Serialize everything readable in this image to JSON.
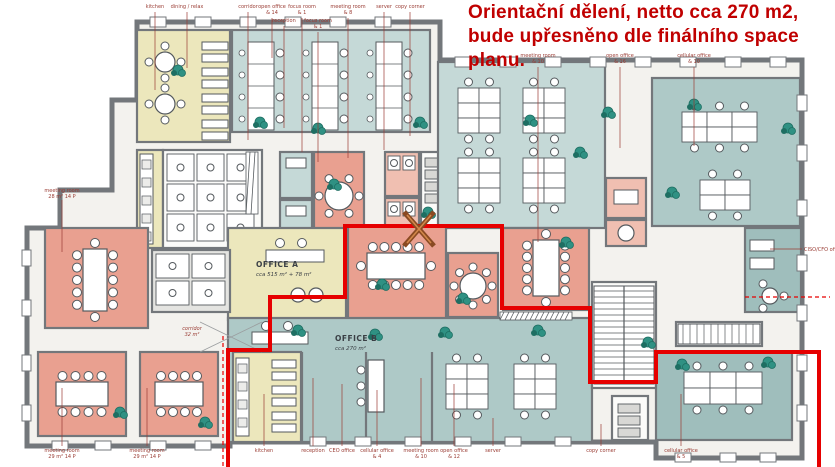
{
  "annotation": {
    "lines": [
      "Orientační dělení, netto cca 270 m2,",
      "bude upřesněno dle finálního space",
      "planu."
    ],
    "color": "#c00000"
  },
  "zones": {
    "office_a": {
      "title": "OFFICE A",
      "area": "cca 515 m² + 78 m²",
      "x": 256,
      "y": 267
    },
    "office_b": {
      "title": "OFFICE B",
      "area": "cca 270 m²",
      "x": 335,
      "y": 341
    }
  },
  "colors": {
    "wall": "#73777b",
    "interior": "#f3f2ee",
    "teal1": "#c5d9d7",
    "teal2": "#aec9c7",
    "teal3": "#9fbebc",
    "salmon": "#e9a090",
    "salmonL": "#f0bfb1",
    "cream": "#ece7bc",
    "white": "#fbfbf9",
    "grayRoom": "#e4e4e1",
    "plant": "#2f9183",
    "plantDark": "#1e6e62",
    "red": "#e60000",
    "labelRed": "#9a3c34",
    "furn": "#555a5e",
    "xBrown": "#8a4a22",
    "xOrange": "#d2874a",
    "zoneText": "#3a3f45"
  },
  "building": {
    "outline": "M137,22 L440,22 L440,60 L802,60 L802,458 L656,458 L656,442 L230,442 L230,446 L27,446 L27,228 L60,228 L60,190 L112,190 L112,100 L137,100 Z"
  },
  "rooms": [
    {
      "id": "dining-relax",
      "x": 137,
      "y": 30,
      "w": 93,
      "h": 112,
      "fill": "cream",
      "furn": [
        {
          "t": "round",
          "cx": 165,
          "cy": 62,
          "r": 10,
          "n": 4
        },
        {
          "t": "round",
          "cx": 165,
          "cy": 104,
          "r": 10,
          "n": 4
        },
        {
          "t": "booth",
          "x": 202,
          "y": 42,
          "n": 4,
          "step": 26,
          "w": 26
        }
      ]
    },
    {
      "id": "open-office-top",
      "x": 232,
      "y": 30,
      "w": 198,
      "h": 102,
      "fill": "teal1",
      "furn": [
        {
          "t": "deskcol",
          "x": 248,
          "y": 42,
          "w": 26,
          "n": 4,
          "seg": 22
        },
        {
          "t": "deskcol",
          "x": 312,
          "y": 42,
          "w": 26,
          "n": 4,
          "seg": 22
        },
        {
          "t": "deskcol",
          "x": 376,
          "y": 42,
          "w": 26,
          "n": 4,
          "seg": 22
        }
      ]
    },
    {
      "id": "locker-strip",
      "x": 137,
      "y": 150,
      "w": 26,
      "h": 98,
      "fill": "cream",
      "furn": [
        {
          "t": "counter",
          "x": 140,
          "y": 154,
          "w": 13,
          "h": 90
        }
      ]
    },
    {
      "id": "wc-block",
      "x": 163,
      "y": 150,
      "w": 99,
      "h": 98,
      "fill": "white",
      "furn": [
        {
          "t": "wc",
          "x": 167,
          "y": 154,
          "cols": 3,
          "rows": 3,
          "cw": 30,
          "ch": 30
        }
      ]
    },
    {
      "id": "focus-room-1",
      "x": 280,
      "y": 152,
      "w": 32,
      "h": 46,
      "fill": "teal1",
      "furn": [
        {
          "t": "box",
          "x": 286,
          "y": 158,
          "w": 20,
          "h": 10,
          "fill": "#ffffff"
        }
      ]
    },
    {
      "id": "focus-room-2",
      "x": 280,
      "y": 200,
      "w": 32,
      "h": 46,
      "fill": "teal1",
      "furn": [
        {
          "t": "box",
          "x": 286,
          "y": 206,
          "w": 20,
          "h": 10,
          "fill": "#ffffff"
        }
      ]
    },
    {
      "id": "meeting-room-mid",
      "x": 314,
      "y": 152,
      "w": 50,
      "h": 96,
      "fill": "salmon",
      "furn": [
        {
          "t": "round",
          "cx": 339,
          "cy": 196,
          "r": 14,
          "n": 6
        }
      ]
    },
    {
      "id": "wc-mid-1",
      "x": 385,
      "y": 152,
      "w": 34,
      "h": 44,
      "fill": "salmonL",
      "furn": [
        {
          "t": "wc",
          "x": 388,
          "y": 156,
          "cols": 2,
          "rows": 1,
          "cw": 15,
          "ch": 17
        }
      ]
    },
    {
      "id": "wc-mid-2",
      "x": 385,
      "y": 198,
      "w": 34,
      "h": 44,
      "fill": "salmonL",
      "furn": [
        {
          "t": "wc",
          "x": 388,
          "y": 202,
          "cols": 2,
          "rows": 1,
          "cw": 15,
          "ch": 17
        }
      ]
    },
    {
      "id": "server-room-mid",
      "x": 421,
      "y": 152,
      "w": 26,
      "h": 76,
      "fill": "white",
      "furn": [
        {
          "t": "racks",
          "x": 425,
          "y": 158,
          "w": 18,
          "n": 4
        }
      ]
    },
    {
      "id": "open-office-mid",
      "x": 438,
      "y": 62,
      "w": 167,
      "h": 166,
      "fill": "teal1",
      "furn": [
        {
          "t": "deskgrid",
          "x": 458,
          "y": 88,
          "cols": 2,
          "rows": 3,
          "dw": 21,
          "dh": 15
        },
        {
          "t": "deskgrid",
          "x": 523,
          "y": 88,
          "cols": 2,
          "rows": 3,
          "dw": 21,
          "dh": 15
        },
        {
          "t": "deskgrid",
          "x": 458,
          "y": 158,
          "cols": 2,
          "rows": 3,
          "dw": 21,
          "dh": 15
        },
        {
          "t": "deskgrid",
          "x": 523,
          "y": 158,
          "cols": 2,
          "rows": 3,
          "dw": 21,
          "dh": 15
        }
      ]
    },
    {
      "id": "focus-booth-1",
      "x": 606,
      "y": 178,
      "w": 40,
      "h": 40,
      "fill": "salmonL",
      "furn": [
        {
          "t": "box",
          "x": 614,
          "y": 190,
          "w": 24,
          "h": 14,
          "fill": "#ffffff"
        }
      ]
    },
    {
      "id": "focus-booth-2",
      "x": 606,
      "y": 220,
      "w": 40,
      "h": 26,
      "fill": "salmonL",
      "furn": [
        {
          "t": "round",
          "cx": 626,
          "cy": 233,
          "r": 8,
          "n": 0
        }
      ]
    },
    {
      "id": "wc-small-right",
      "x": 653,
      "y": 162,
      "w": 26,
      "h": 22,
      "fill": "salmonL",
      "furn": []
    },
    {
      "id": "cellular-office-tr",
      "x": 652,
      "y": 78,
      "w": 148,
      "h": 148,
      "fill": "teal2",
      "furn": [
        {
          "t": "deskgrid",
          "x": 682,
          "y": 112,
          "cols": 3,
          "rows": 2,
          "dw": 25,
          "dh": 15
        },
        {
          "t": "deskgrid",
          "x": 700,
          "y": 180,
          "cols": 2,
          "rows": 2,
          "dw": 25,
          "dh": 15
        }
      ]
    },
    {
      "id": "ciso-cfo-office",
      "x": 745,
      "y": 228,
      "w": 56,
      "h": 84,
      "fill": "teal3",
      "furn": [
        {
          "t": "box",
          "x": 750,
          "y": 240,
          "w": 24,
          "h": 11,
          "fill": "#ffffff"
        },
        {
          "t": "box",
          "x": 750,
          "y": 258,
          "w": 24,
          "h": 11,
          "fill": "#ffffff"
        },
        {
          "t": "round",
          "cx": 770,
          "cy": 296,
          "r": 8,
          "n": 3
        }
      ]
    },
    {
      "id": "office-a",
      "x": 228,
      "y": 228,
      "w": 118,
      "h": 92,
      "fill": "cream",
      "furn": [
        {
          "t": "box",
          "x": 266,
          "y": 250,
          "w": 58,
          "h": 12,
          "fill": "#ffffff"
        },
        {
          "t": "chairs2",
          "x": 280,
          "y": 243,
          "n": 2,
          "step": 22
        },
        {
          "t": "round",
          "cx": 298,
          "cy": 295,
          "r": 7,
          "n": 0
        },
        {
          "t": "round",
          "cx": 316,
          "cy": 295,
          "r": 7,
          "n": 0
        }
      ]
    },
    {
      "id": "meeting-room-a",
      "x": 348,
      "y": 226,
      "w": 98,
      "h": 94,
      "fill": "salmon",
      "furn": [
        {
          "t": "conf",
          "cx": 396,
          "cy": 266,
          "w": 58,
          "h": 26,
          "nx": 5,
          "ny": 1
        }
      ]
    },
    {
      "id": "round-room",
      "x": 448,
      "y": 253,
      "w": 50,
      "h": 64,
      "fill": "salmon",
      "furn": [
        {
          "t": "round",
          "cx": 473,
          "cy": 286,
          "r": 13,
          "n": 8
        }
      ]
    },
    {
      "id": "meeting-room-b",
      "x": 503,
      "y": 228,
      "w": 86,
      "h": 82,
      "fill": "salmon",
      "furn": [
        {
          "t": "conf",
          "cx": 546,
          "cy": 268,
          "w": 26,
          "h": 56,
          "nx": 1,
          "ny": 5
        }
      ]
    },
    {
      "id": "meeting-room-left",
      "x": 45,
      "y": 228,
      "w": 103,
      "h": 100,
      "fill": "salmon",
      "furn": [
        {
          "t": "conf",
          "cx": 95,
          "cy": 280,
          "w": 24,
          "h": 62,
          "nx": 1,
          "ny": 5
        }
      ]
    },
    {
      "id": "wc-left",
      "x": 152,
      "y": 250,
      "w": 78,
      "h": 62,
      "fill": "grayRoom",
      "furn": [
        {
          "t": "wc",
          "x": 156,
          "y": 254,
          "cols": 2,
          "rows": 2,
          "cw": 36,
          "ch": 27
        }
      ]
    },
    {
      "id": "meeting-room-bl1",
      "x": 38,
      "y": 352,
      "w": 88,
      "h": 84,
      "fill": "salmon",
      "furn": [
        {
          "t": "conf",
          "cx": 82,
          "cy": 394,
          "w": 52,
          "h": 24,
          "nx": 4,
          "ny": 0
        }
      ]
    },
    {
      "id": "meeting-room-bl2",
      "x": 140,
      "y": 352,
      "w": 78,
      "h": 84,
      "fill": "salmon",
      "furn": [
        {
          "t": "conf",
          "cx": 179,
          "cy": 394,
          "w": 48,
          "h": 24,
          "nx": 4,
          "ny": 0
        }
      ]
    },
    {
      "id": "office-b",
      "x": 228,
      "y": 318,
      "w": 364,
      "h": 124,
      "fill": "teal2",
      "furn": [
        {
          "t": "box",
          "x": 252,
          "y": 332,
          "w": 56,
          "h": 12,
          "fill": "#ffffff"
        },
        {
          "t": "chairs2",
          "x": 266,
          "y": 326,
          "n": 2,
          "step": 22
        },
        {
          "t": "recep",
          "x": 368,
          "y": 360,
          "w": 16,
          "h": 52
        },
        {
          "t": "deskgrid",
          "x": 446,
          "y": 364,
          "cols": 2,
          "rows": 3,
          "dw": 21,
          "dh": 15
        },
        {
          "t": "deskgrid",
          "x": 514,
          "y": 364,
          "cols": 2,
          "rows": 3,
          "dw": 21,
          "dh": 15
        }
      ]
    },
    {
      "id": "kitchen-b",
      "x": 233,
      "y": 352,
      "w": 68,
      "h": 90,
      "fill": "cream",
      "furn": [
        {
          "t": "counter",
          "x": 236,
          "y": 358,
          "w": 13,
          "h": 78
        },
        {
          "t": "booth",
          "x": 272,
          "y": 360,
          "n": 3,
          "step": 26,
          "w": 24
        }
      ]
    },
    {
      "id": "stairs-main",
      "x": 592,
      "y": 282,
      "w": 64,
      "h": 106,
      "fill": "white",
      "furn": [
        {
          "t": "stairs",
          "x": 594,
          "y": 286,
          "w": 60,
          "h": 98,
          "vert": false
        }
      ]
    },
    {
      "id": "stairs-low",
      "x": 676,
      "y": 322,
      "w": 86,
      "h": 24,
      "fill": "white",
      "furn": [
        {
          "t": "stairs",
          "x": 678,
          "y": 324,
          "w": 82,
          "h": 20,
          "vert": true
        }
      ]
    },
    {
      "id": "cellular-office-br",
      "x": 656,
      "y": 352,
      "w": 136,
      "h": 88,
      "fill": "teal3",
      "furn": [
        {
          "t": "deskgrid",
          "x": 684,
          "y": 372,
          "cols": 3,
          "rows": 2,
          "dw": 26,
          "dh": 16
        }
      ]
    },
    {
      "id": "copy-corner-room",
      "x": 612,
      "y": 396,
      "w": 36,
      "h": 44,
      "fill": "white",
      "furn": [
        {
          "t": "racks",
          "x": 618,
          "y": 404,
          "w": 22,
          "n": 3
        }
      ]
    }
  ],
  "partitions": [
    [
      302,
      352,
      302,
      442
    ],
    [
      366,
      352,
      366,
      442
    ],
    [
      432,
      352,
      432,
      442
    ]
  ],
  "hatches": [
    [
      500,
      312,
      72,
      8
    ],
    [
      246,
      152,
      12,
      62
    ]
  ],
  "cross_lines": [
    [
      200,
      322,
      262,
      352
    ]
  ],
  "windows": [
    [
      150,
      17,
      16,
      10
    ],
    [
      195,
      17,
      16,
      10
    ],
    [
      240,
      17,
      16,
      10
    ],
    [
      285,
      17,
      16,
      10
    ],
    [
      330,
      17,
      16,
      10
    ],
    [
      375,
      17,
      16,
      10
    ],
    [
      455,
      57,
      16,
      10
    ],
    [
      500,
      57,
      16,
      10
    ],
    [
      545,
      57,
      16,
      10
    ],
    [
      590,
      57,
      16,
      10
    ],
    [
      635,
      57,
      16,
      10
    ],
    [
      680,
      57,
      16,
      10
    ],
    [
      725,
      57,
      16,
      10
    ],
    [
      770,
      57,
      16,
      10
    ],
    [
      797,
      95,
      10,
      16
    ],
    [
      797,
      145,
      10,
      16
    ],
    [
      797,
      200,
      10,
      16
    ],
    [
      797,
      255,
      10,
      16
    ],
    [
      797,
      305,
      10,
      16
    ],
    [
      797,
      355,
      10,
      16
    ],
    [
      797,
      405,
      10,
      16
    ],
    [
      52,
      441,
      16,
      9
    ],
    [
      95,
      441,
      16,
      9
    ],
    [
      150,
      441,
      16,
      9
    ],
    [
      195,
      441,
      16,
      9
    ],
    [
      310,
      437,
      16,
      9
    ],
    [
      355,
      437,
      16,
      9
    ],
    [
      405,
      437,
      16,
      9
    ],
    [
      455,
      437,
      16,
      9
    ],
    [
      505,
      437,
      16,
      9
    ],
    [
      555,
      437,
      16,
      9
    ],
    [
      675,
      453,
      16,
      9
    ],
    [
      720,
      453,
      16,
      9
    ],
    [
      760,
      453,
      16,
      9
    ],
    [
      22,
      250,
      9,
      16
    ],
    [
      22,
      300,
      9,
      16
    ],
    [
      22,
      355,
      9,
      16
    ],
    [
      22,
      405,
      9,
      16
    ]
  ],
  "plants": [
    [
      178,
      70
    ],
    [
      260,
      122
    ],
    [
      318,
      128
    ],
    [
      420,
      122
    ],
    [
      334,
      184
    ],
    [
      428,
      212
    ],
    [
      382,
      284
    ],
    [
      463,
      298
    ],
    [
      566,
      242
    ],
    [
      694,
      104
    ],
    [
      788,
      128
    ],
    [
      672,
      192
    ],
    [
      608,
      112
    ],
    [
      530,
      120
    ],
    [
      648,
      342
    ],
    [
      682,
      364
    ],
    [
      768,
      362
    ],
    [
      120,
      412
    ],
    [
      205,
      422
    ],
    [
      375,
      334
    ],
    [
      298,
      330
    ],
    [
      580,
      152
    ],
    [
      445,
      332
    ],
    [
      538,
      330
    ]
  ],
  "red_boundary": {
    "points": [
      [
        228,
        467
      ],
      [
        228,
        350
      ],
      [
        270,
        350
      ],
      [
        270,
        297
      ],
      [
        345,
        297
      ],
      [
        345,
        226
      ],
      [
        502,
        226
      ],
      [
        502,
        308
      ],
      [
        590,
        308
      ],
      [
        590,
        382
      ],
      [
        656,
        382
      ],
      [
        656,
        352
      ],
      [
        819,
        352
      ],
      [
        819,
        467
      ]
    ],
    "dashed": [
      [
        223,
        336,
        223,
        467
      ],
      [
        745,
        297,
        830,
        297
      ]
    ],
    "x_mark": {
      "x1": 404,
      "y1": 212,
      "x2": 434,
      "y2": 246
    }
  },
  "labels": [
    {
      "t": "kitchen",
      "x": 155,
      "y": 8,
      "ly1": 12,
      "ly2": 90
    },
    {
      "t": "dining / relax",
      "x": 187,
      "y": 8,
      "ly1": 12,
      "ly2": 68
    },
    {
      "t": "corridor",
      "x": 248,
      "y": 8,
      "ly1": 12,
      "ly2": 140
    },
    {
      "t": "open office",
      "s": "& 14",
      "x": 272,
      "y": 8,
      "ly1": 18,
      "ly2": 58
    },
    {
      "t": "reception",
      "x": 284,
      "y": 22,
      "ly1": 26,
      "ly2": 128
    },
    {
      "t": "focus room",
      "s": "& 1",
      "x": 302,
      "y": 8,
      "ly1": 18,
      "ly2": 152
    },
    {
      "t": "focus room",
      "s": "& 1",
      "x": 318,
      "y": 22,
      "ly1": 32,
      "ly2": 162
    },
    {
      "t": "meeting room",
      "s": "& 8",
      "x": 348,
      "y": 8,
      "ly1": 18,
      "ly2": 158
    },
    {
      "t": "server",
      "x": 384,
      "y": 8,
      "ly1": 12,
      "ly2": 150
    },
    {
      "t": "copy corner",
      "x": 410,
      "y": 8,
      "ly1": 12,
      "ly2": 136
    },
    {
      "t": "meeting room",
      "s": "& 10",
      "x": 538,
      "y": 57,
      "ly1": 67,
      "ly2": 242
    },
    {
      "t": "open office",
      "s": "& 16",
      "x": 620,
      "y": 57,
      "ly1": 67,
      "ly2": 148
    },
    {
      "t": "cellular office",
      "s": "& 10",
      "x": 694,
      "y": 57,
      "ly1": 67,
      "ly2": 146
    },
    {
      "t": "meeting room",
      "s": "28 m²  14 P",
      "x": 62,
      "y": 192,
      "ly1": 200,
      "ly2": 252
    },
    {
      "t": "CISO/CFO office",
      "x": 804,
      "y": 251,
      "anchor": "start",
      "lh": [
        802,
        770,
        249
      ]
    },
    {
      "t": "corridor",
      "s": "32 m²",
      "x": 192,
      "y": 330,
      "italic": true
    },
    {
      "t": "meeting room",
      "s": "29 m²  14 P",
      "x": 62,
      "y": 452,
      "ly1": 446,
      "ly2": 388
    },
    {
      "t": "meeting room",
      "s": "29 m²  14 P",
      "x": 147,
      "y": 452,
      "ly1": 446,
      "ly2": 388
    },
    {
      "t": "kitchen",
      "x": 264,
      "y": 452,
      "ly1": 446,
      "ly2": 394
    },
    {
      "t": "reception",
      "x": 313,
      "y": 452,
      "ly1": 446,
      "ly2": 378
    },
    {
      "t": "CEO office",
      "x": 342,
      "y": 452,
      "ly1": 446,
      "ly2": 384
    },
    {
      "t": "cellular office",
      "s": "& 4",
      "x": 377,
      "y": 452,
      "ly1": 446,
      "ly2": 390
    },
    {
      "t": "meeting room",
      "s": "& 10",
      "x": 421,
      "y": 452,
      "ly1": 446,
      "ly2": 378
    },
    {
      "t": "open office",
      "s": "& 12",
      "x": 454,
      "y": 452,
      "ly1": 446,
      "ly2": 384
    },
    {
      "t": "server",
      "x": 493,
      "y": 452,
      "ly1": 446,
      "ly2": 418
    },
    {
      "t": "copy corner",
      "x": 601,
      "y": 452,
      "ly1": 446,
      "ly2": 424
    },
    {
      "t": "cellular office",
      "s": "& 5",
      "x": 681,
      "y": 452,
      "ly1": 446,
      "ly2": 394
    }
  ]
}
